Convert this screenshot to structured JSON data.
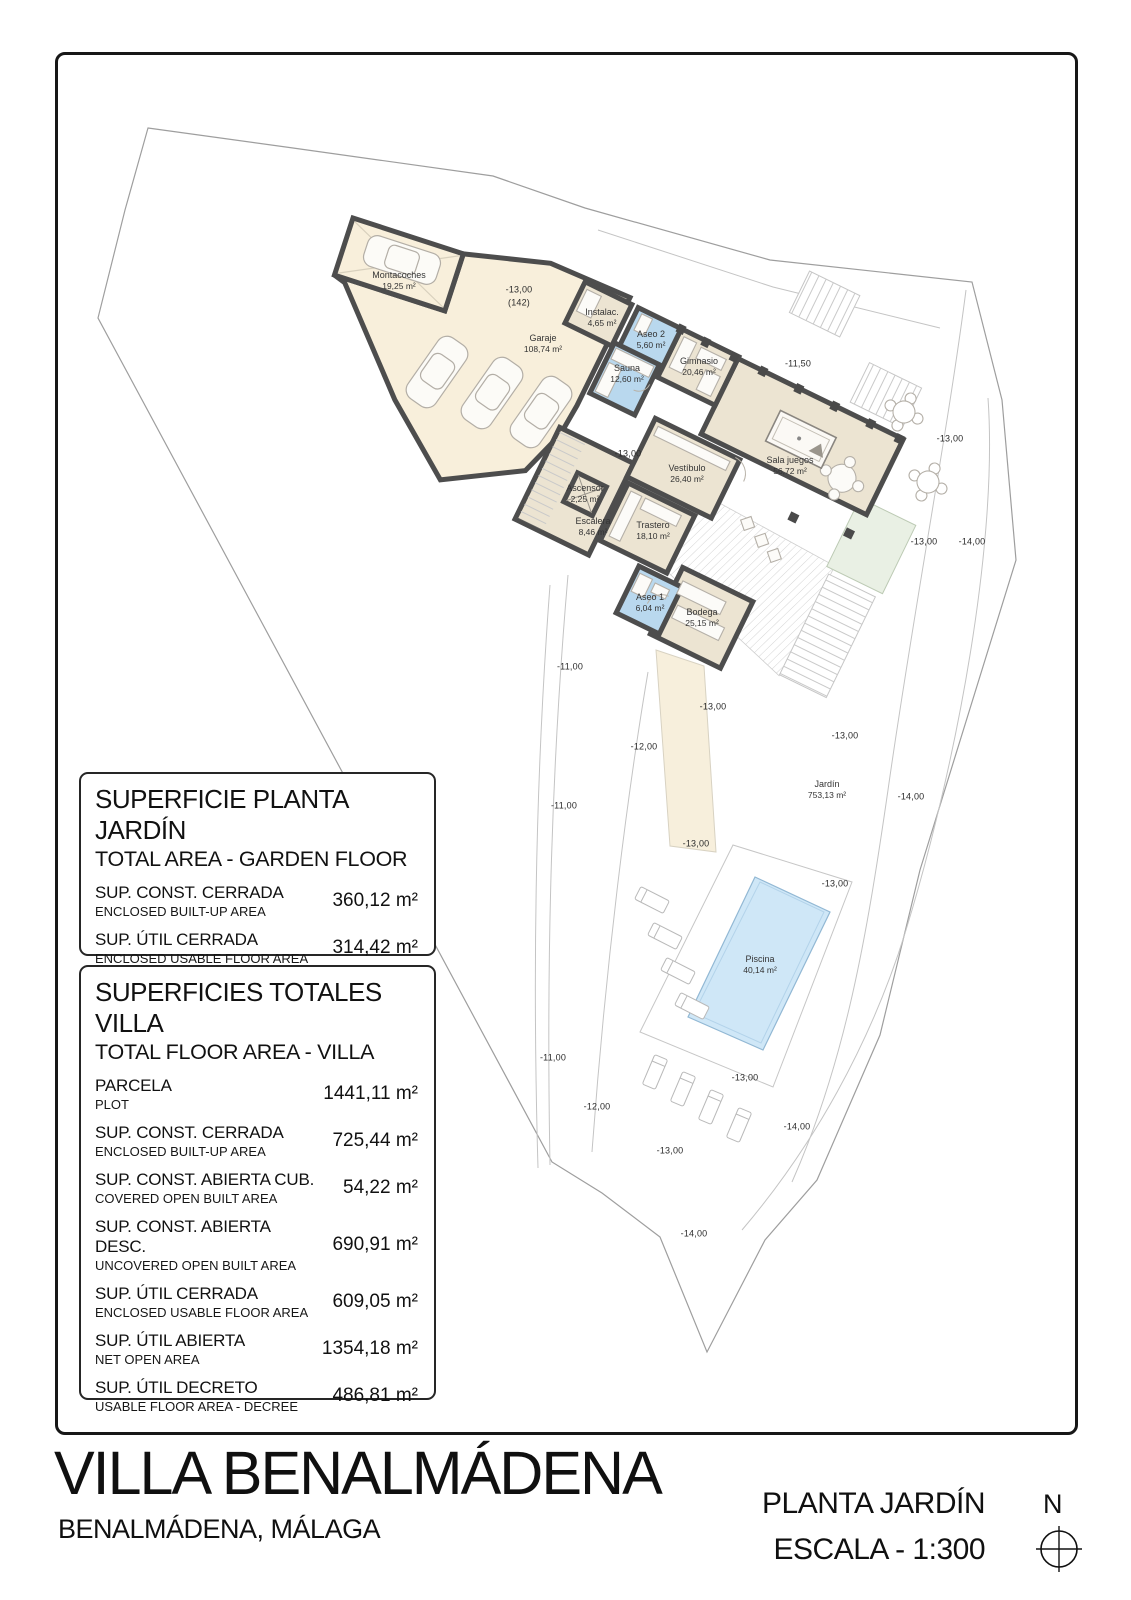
{
  "title_block": {
    "project": "VILLA BENALMÁDENA",
    "location": "BENALMÁDENA, MÁLAGA",
    "plan_name": "PLANTA JARDÍN",
    "scale": "ESCALA - 1:300",
    "north": "N"
  },
  "tables": [
    {
      "title": "SUPERFICIE PLANTA JARDÍN",
      "subtitle": "TOTAL AREA - GARDEN FLOOR",
      "rows": [
        {
          "label": "SUP. CONST. CERRADA",
          "sublabel": "ENCLOSED BUILT-UP AREA",
          "value": "360,12 m²"
        },
        {
          "label": "SUP. ÚTIL CERRADA",
          "sublabel": "ENCLOSED USABLE FLOOR AREA",
          "value": "314,42 m²"
        }
      ]
    },
    {
      "title": "SUPERFICIES TOTALES VILLA",
      "subtitle": "TOTAL FLOOR AREA - VILLA",
      "rows": [
        {
          "label": "PARCELA",
          "sublabel": "PLOT",
          "value": "1441,11 m²"
        },
        {
          "label": "SUP. CONST. CERRADA",
          "sublabel": "ENCLOSED BUILT-UP AREA",
          "value": "725,44 m²"
        },
        {
          "label": "SUP. CONST. ABIERTA CUB.",
          "sublabel": "COVERED OPEN BUILT AREA",
          "value": "54,22 m²"
        },
        {
          "label": "SUP. CONST. ABIERTA DESC.",
          "sublabel": "UNCOVERED OPEN BUILT AREA",
          "value": "690,91 m²"
        },
        {
          "label": "SUP. ÚTIL CERRADA",
          "sublabel": "ENCLOSED USABLE FLOOR AREA",
          "value": "609,05 m²"
        },
        {
          "label": "SUP. ÚTIL ABIERTA",
          "sublabel": "NET OPEN AREA",
          "value": "1354,18 m²"
        },
        {
          "label": "SUP. ÚTIL DECRETO",
          "sublabel": "USABLE FLOOR AREA - DECREE",
          "value": "486,81 m²"
        }
      ]
    }
  ],
  "plan": {
    "rooms": [
      {
        "name": "Montacoches",
        "area": "19,25 m²"
      },
      {
        "name": "Garaje",
        "area": "108,74 m²"
      },
      {
        "name": "Instalac.",
        "area": "4,65 m²"
      },
      {
        "name": "Aseo 2",
        "area": "5,60 m²"
      },
      {
        "name": "Sauna",
        "area": "12,60 m²"
      },
      {
        "name": "Gimnasio",
        "area": "20,46 m²"
      },
      {
        "name": "Vestíbulo",
        "area": "26,40 m²"
      },
      {
        "name": "Sala juegos",
        "area": "56,72 m²"
      },
      {
        "name": "Ascensor",
        "area": "2,25 m²"
      },
      {
        "name": "Escalera",
        "area": "8,46 m²"
      },
      {
        "name": "Trastero",
        "area": "18,10 m²"
      },
      {
        "name": "Aseo 1",
        "area": "6,04 m²"
      },
      {
        "name": "Bodega",
        "area": "25,15 m²"
      },
      {
        "name": "Jardín",
        "area": "753,13 m²"
      },
      {
        "name": "Piscina",
        "area": "40,14 m²"
      }
    ],
    "elevations": [
      "-13,00",
      "(142)",
      "-11,50",
      "-13,00",
      "-13,00",
      "-13,00",
      "-14,00",
      "-11,00",
      "-13,00",
      "-12,00",
      "-13,00",
      "-11,00",
      "-14,00",
      "-13,00",
      "-13,00",
      "-11,00",
      "-13,00",
      "-12,00",
      "-14,00",
      "-13,00",
      "-14,00"
    ],
    "colors": {
      "wall": "#4d4d4d",
      "floor": "#ece4d2",
      "garage_floor": "#f8efdb",
      "wet_room": "#b9d8ee",
      "pool": "#cfe7f7",
      "green_area": "#e9f0e4"
    }
  }
}
